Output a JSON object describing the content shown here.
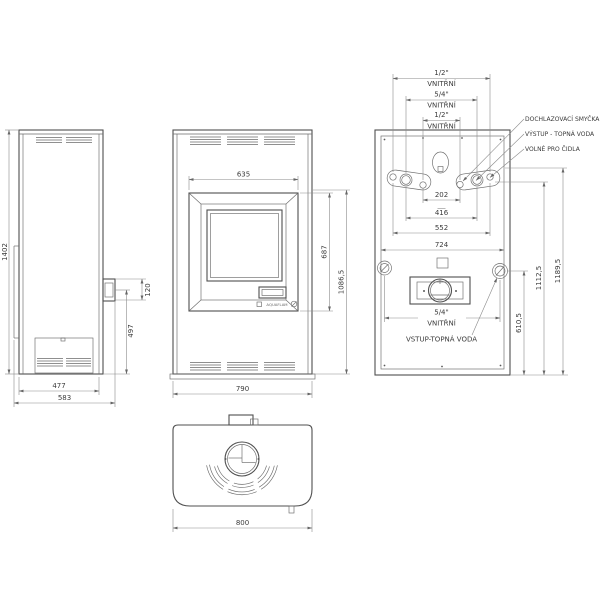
{
  "drawing": {
    "side": {
      "depth_body": "477",
      "depth_total": "583",
      "height_total": "1402",
      "flue_stub_size": "120",
      "flue_stub_height": "497"
    },
    "front": {
      "door_width": "635",
      "door_height": "687",
      "door_top_height": "1086,5",
      "width_total": "790",
      "logo": "AQUAFLAM"
    },
    "rear": {
      "thread_half": "1/2\"",
      "thread_fivequarter": "5/4\"",
      "thread_type": "VNITŘNÍ",
      "conn_inner": "202",
      "conn_mid": "416",
      "conn_outer": "552",
      "panel_width": "724",
      "inlet_height": "610,5",
      "upper_conn_height": "1112,5",
      "top_conn_height": "1189,5",
      "callout_cooling_loop": "DOCHLAZOVACÍ SMYČKA",
      "callout_output": "VÝSTUP - TOPNÁ VODA",
      "callout_sensors": "VOLNÉ PRO ČIDLA",
      "callout_input": "VSTUP-TOPNÁ VODA",
      "inlet_thread": "5/4\""
    },
    "top": {
      "width_total": "800"
    }
  }
}
